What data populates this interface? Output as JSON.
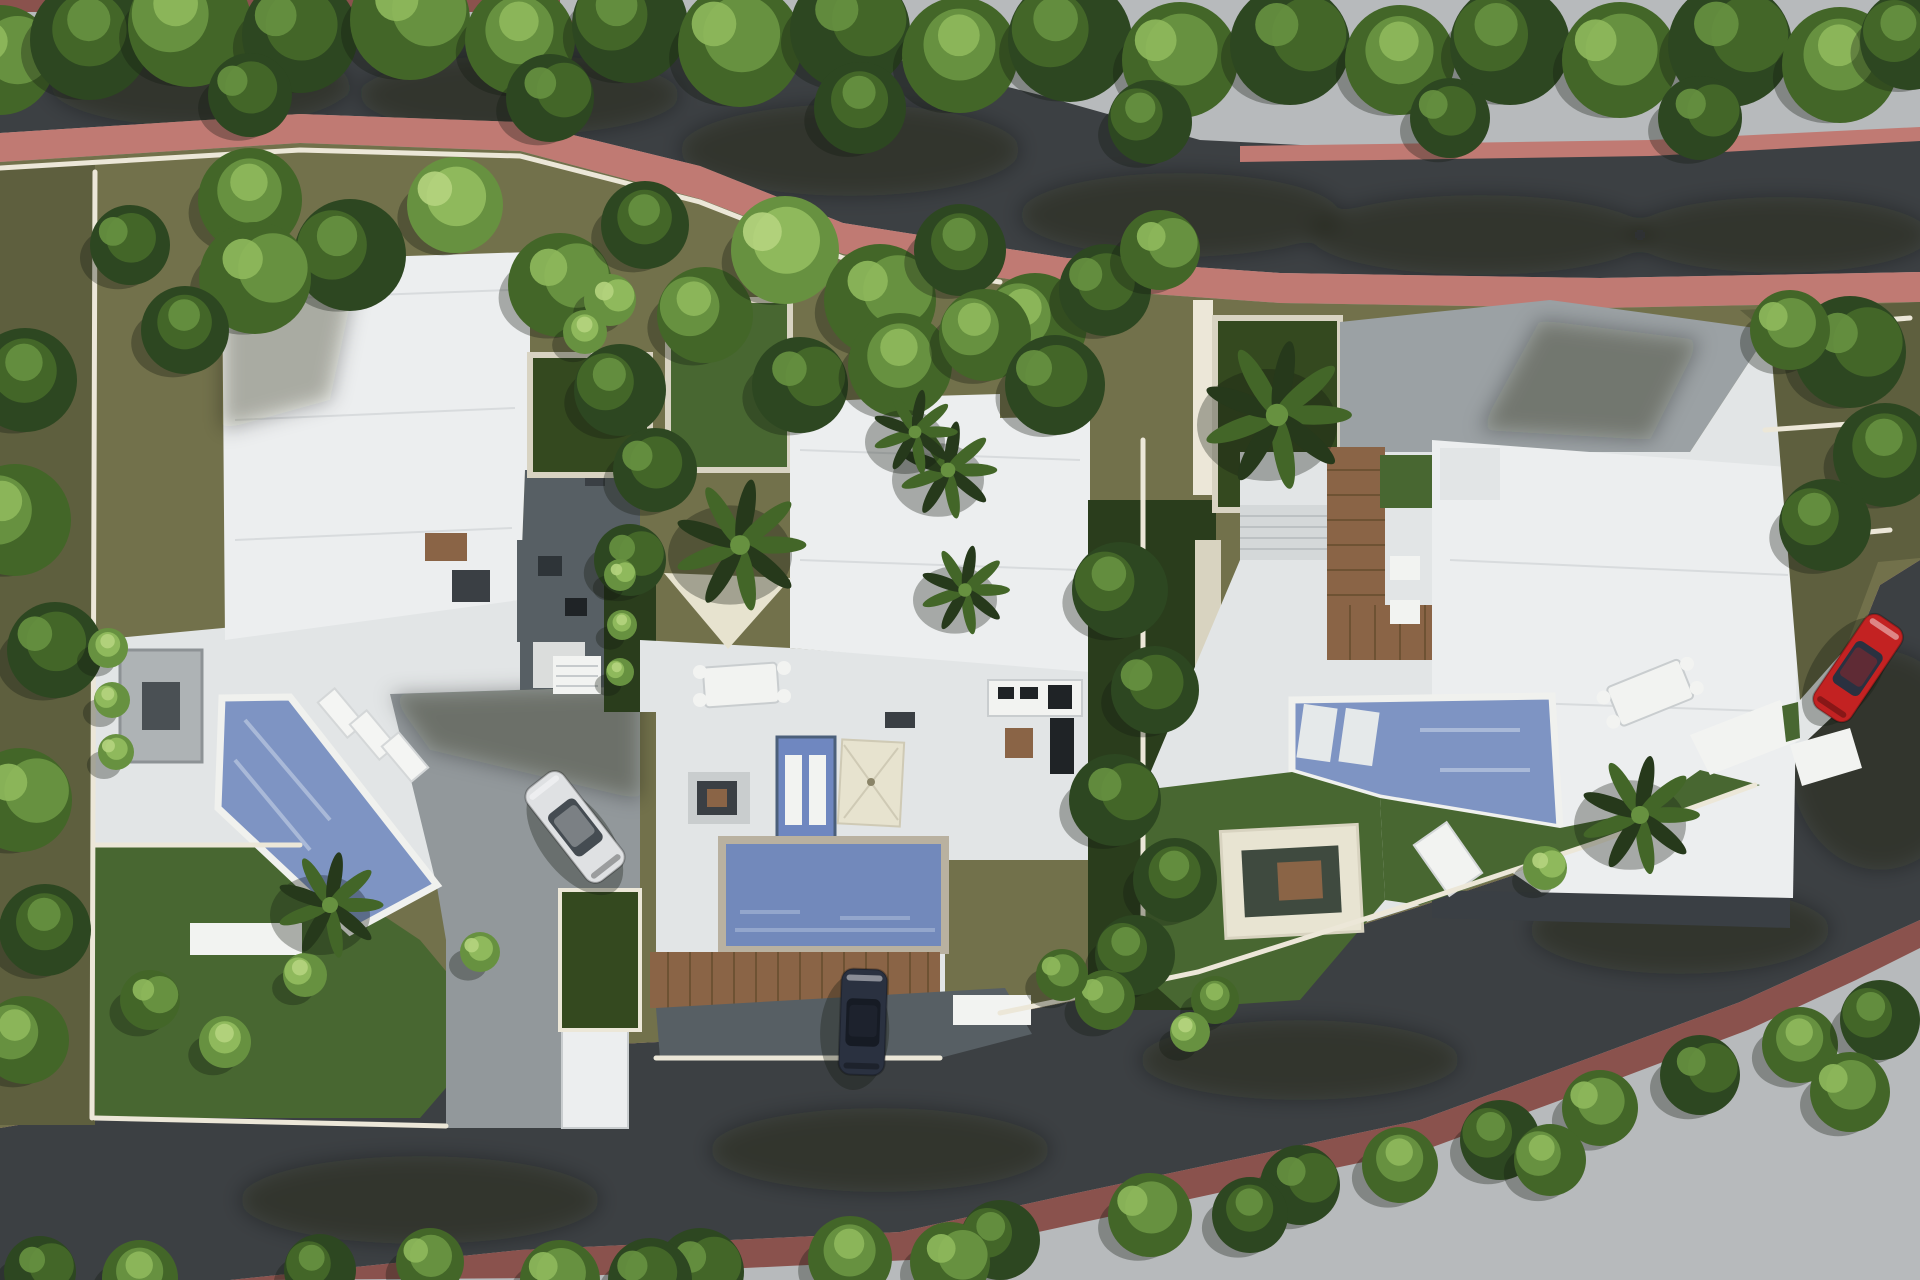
{
  "meta": {
    "type": "aerial-3d-site-plan-rendering",
    "subject": "residential development with three modern villas, private pools, gardens and a looping asphalt road lined with trees",
    "villa_count": 3,
    "visible_vehicles": [
      "silver-sedan-driveway",
      "red-car-street-parked",
      "dark-van-entrance"
    ]
  },
  "palette": {
    "pavement": "#b7babc",
    "road": "#3c4043",
    "road_shadow": "#2b2f32",
    "sidewalk_pink": "#c07a73",
    "sidewalk_rose": "#b46d66",
    "sidewalk_maroon": "#8a524d",
    "olive": "#72714b",
    "olive_dark": "#5e5f3e",
    "lawn": "#486731",
    "lawn_dark": "#34491f",
    "garden_dark": "#2a3d1c",
    "wall_cream": "#ece7d8",
    "roof_white": "#eceeef",
    "terrace_white": "#e2e5e6",
    "terrace_gray": "#9ba1a4",
    "paver_gray": "#92989b",
    "paver_shadow": "#575f64",
    "pool_blue": "#7e94c3",
    "pool_blue2": "#7289bb",
    "pool_rim": "#f0f1ee",
    "pool_stone": "#b9b1a0",
    "sail_cream": "#e7e3cf",
    "deck_wood": "#8a6446",
    "car_silver": "#dfe1e3",
    "car_glass": "#454c52",
    "car_red": "#c32222",
    "car_dark": "#2a3140",
    "tree_dark": "#2d4721",
    "tree_mid": "#436628",
    "tree_light": "#679140",
    "tree_lighter": "#8fb95c",
    "palm_dark": "#26391b",
    "shadow": "rgba(18,24,14,0.32)"
  },
  "scene": {
    "trees": [
      [
        0,
        60,
        55,
        "m"
      ],
      [
        90,
        40,
        60,
        "d"
      ],
      [
        190,
        25,
        62,
        "m"
      ],
      [
        300,
        35,
        58,
        "d"
      ],
      [
        410,
        20,
        60,
        "m"
      ],
      [
        520,
        40,
        55,
        "m"
      ],
      [
        630,
        25,
        58,
        "d"
      ],
      [
        740,
        45,
        62,
        "m"
      ],
      [
        850,
        30,
        60,
        "d"
      ],
      [
        960,
        55,
        58,
        "m"
      ],
      [
        1070,
        40,
        62,
        "d"
      ],
      [
        1180,
        60,
        58,
        "m"
      ],
      [
        1290,
        45,
        60,
        "d"
      ],
      [
        1400,
        60,
        55,
        "m"
      ],
      [
        1510,
        45,
        60,
        "d"
      ],
      [
        1620,
        60,
        58,
        "m"
      ],
      [
        1730,
        45,
        62,
        "d"
      ],
      [
        1840,
        65,
        58,
        "m"
      ],
      [
        1910,
        40,
        50,
        "d"
      ],
      [
        250,
        95,
        42,
        "d"
      ],
      [
        550,
        98,
        44,
        "d"
      ],
      [
        860,
        108,
        46,
        "d"
      ],
      [
        1150,
        122,
        42,
        "d"
      ],
      [
        1450,
        118,
        40,
        "d"
      ],
      [
        1700,
        118,
        42,
        "d"
      ],
      [
        250,
        200,
        52,
        "m"
      ],
      [
        350,
        255,
        56,
        "d"
      ],
      [
        455,
        205,
        48,
        "l"
      ],
      [
        560,
        285,
        52,
        "m"
      ],
      [
        645,
        225,
        44,
        "d"
      ],
      [
        705,
        315,
        48,
        "m"
      ],
      [
        785,
        250,
        54,
        "l"
      ],
      [
        880,
        300,
        56,
        "m"
      ],
      [
        960,
        250,
        46,
        "d"
      ],
      [
        1035,
        325,
        52,
        "m"
      ],
      [
        1105,
        290,
        46,
        "d"
      ],
      [
        1160,
        250,
        40,
        "m"
      ],
      [
        25,
        380,
        52,
        "d"
      ],
      [
        15,
        520,
        56,
        "m"
      ],
      [
        55,
        650,
        48,
        "d"
      ],
      [
        20,
        800,
        52,
        "m"
      ],
      [
        45,
        930,
        46,
        "d"
      ],
      [
        25,
        1040,
        44,
        "m"
      ],
      [
        130,
        245,
        40,
        "d"
      ],
      [
        255,
        278,
        56,
        "m"
      ],
      [
        185,
        330,
        44,
        "d"
      ],
      [
        620,
        390,
        46,
        "d"
      ],
      [
        655,
        470,
        42,
        "d"
      ],
      [
        630,
        560,
        36,
        "d"
      ],
      [
        108,
        648,
        20,
        "l"
      ],
      [
        112,
        700,
        18,
        "l"
      ],
      [
        116,
        752,
        18,
        "l"
      ],
      [
        150,
        1000,
        30,
        "m"
      ],
      [
        225,
        1042,
        26,
        "l"
      ],
      [
        305,
        975,
        22,
        "l"
      ],
      [
        480,
        952,
        20,
        "l"
      ],
      [
        800,
        385,
        48,
        "d"
      ],
      [
        900,
        365,
        52,
        "m"
      ],
      [
        985,
        335,
        46,
        "m"
      ],
      [
        1055,
        385,
        50,
        "d"
      ],
      [
        610,
        300,
        26,
        "l"
      ],
      [
        585,
        332,
        22,
        "l"
      ],
      [
        1120,
        590,
        48,
        "d"
      ],
      [
        1155,
        690,
        44,
        "d"
      ],
      [
        1115,
        800,
        46,
        "d"
      ],
      [
        1175,
        880,
        42,
        "d"
      ],
      [
        1135,
        955,
        40,
        "d"
      ],
      [
        1105,
        1000,
        30,
        "m"
      ],
      [
        620,
        575,
        16,
        "l"
      ],
      [
        622,
        625,
        15,
        "l"
      ],
      [
        620,
        672,
        14,
        "l"
      ],
      [
        1062,
        975,
        26,
        "m"
      ],
      [
        1850,
        352,
        56,
        "d"
      ],
      [
        1885,
        455,
        52,
        "d"
      ],
      [
        1825,
        525,
        46,
        "d"
      ],
      [
        1790,
        330,
        40,
        "m"
      ],
      [
        1545,
        868,
        22,
        "l"
      ],
      [
        1215,
        1000,
        24,
        "m"
      ],
      [
        1190,
        1032,
        20,
        "l"
      ],
      [
        560,
        1280,
        40,
        "m"
      ],
      [
        700,
        1272,
        44,
        "d"
      ],
      [
        850,
        1258,
        42,
        "m"
      ],
      [
        1000,
        1240,
        40,
        "d"
      ],
      [
        1150,
        1215,
        42,
        "m"
      ],
      [
        1300,
        1185,
        40,
        "d"
      ],
      [
        1400,
        1165,
        38,
        "m"
      ],
      [
        1500,
        1140,
        40,
        "d"
      ],
      [
        1600,
        1108,
        38,
        "m"
      ],
      [
        1700,
        1075,
        40,
        "d"
      ],
      [
        1800,
        1045,
        38,
        "m"
      ],
      [
        1880,
        1020,
        40,
        "d"
      ],
      [
        650,
        1280,
        42,
        "d"
      ],
      [
        950,
        1262,
        40,
        "m"
      ],
      [
        1250,
        1215,
        38,
        "d"
      ],
      [
        1550,
        1160,
        36,
        "m"
      ],
      [
        1850,
        1092,
        40,
        "m"
      ],
      [
        40,
        1272,
        36,
        "d"
      ],
      [
        140,
        1278,
        38,
        "m"
      ],
      [
        320,
        1270,
        36,
        "d"
      ],
      [
        430,
        1262,
        34,
        "m"
      ]
    ],
    "palms": [
      [
        740,
        545,
        62
      ],
      [
        948,
        470,
        46
      ],
      [
        965,
        590,
        42
      ],
      [
        915,
        432,
        40
      ],
      [
        1277,
        415,
        70
      ],
      [
        1640,
        815,
        56
      ],
      [
        330,
        905,
        50
      ]
    ],
    "cars": [
      {
        "name": "silver-sedan",
        "body": "car_silver",
        "glass": "car_glass",
        "x": 575,
        "y": 827,
        "rot": -38,
        "len": 118,
        "wid": 46
      },
      {
        "name": "red-car",
        "body": "car_red",
        "glass": "car_dark",
        "x": 1858,
        "y": 668,
        "rot": 34,
        "len": 112,
        "wid": 44
      },
      {
        "name": "dark-van",
        "body": "car_dark",
        "glass": "#161b24",
        "x": 863,
        "y": 1022,
        "rot": 2,
        "len": 106,
        "wid": 46
      }
    ]
  }
}
